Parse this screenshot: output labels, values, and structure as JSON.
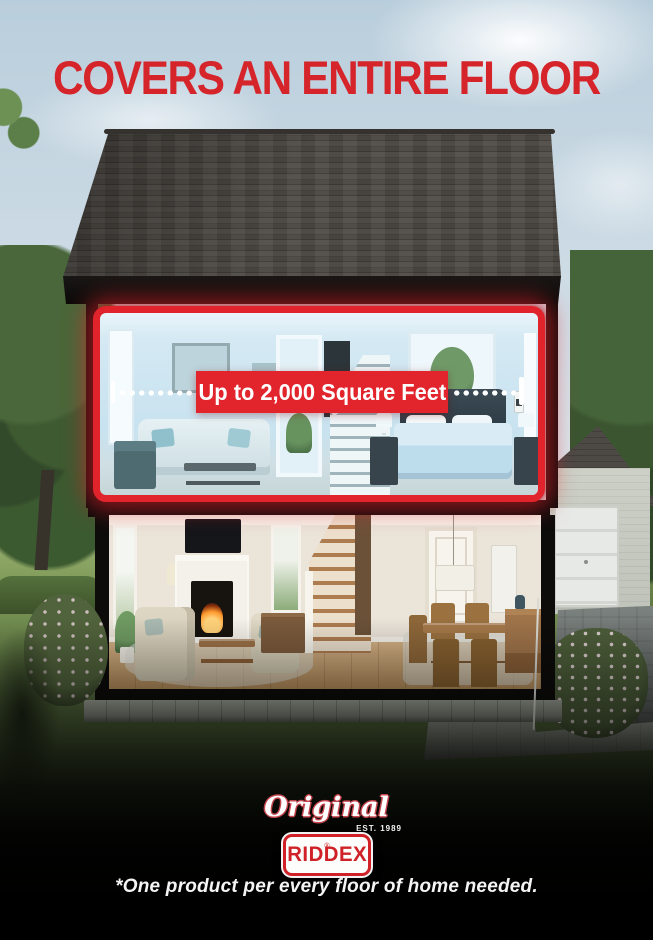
{
  "headline": {
    "text": "COVERS AN ENTIRE FLOOR",
    "color": "#d6242b"
  },
  "banner": {
    "text": "Up to 2,000 Square Feet",
    "bg_color": "#e2242c",
    "text_color": "#ffffff"
  },
  "highlight": {
    "outline_color": "#e1232b"
  },
  "logo": {
    "script": "Original",
    "established": "EST. 1989",
    "brand": "RIDDEX",
    "registered_mark": "®",
    "brand_color": "#cf2127"
  },
  "disclaimer": {
    "text": "*One product per every floor of home needed."
  }
}
